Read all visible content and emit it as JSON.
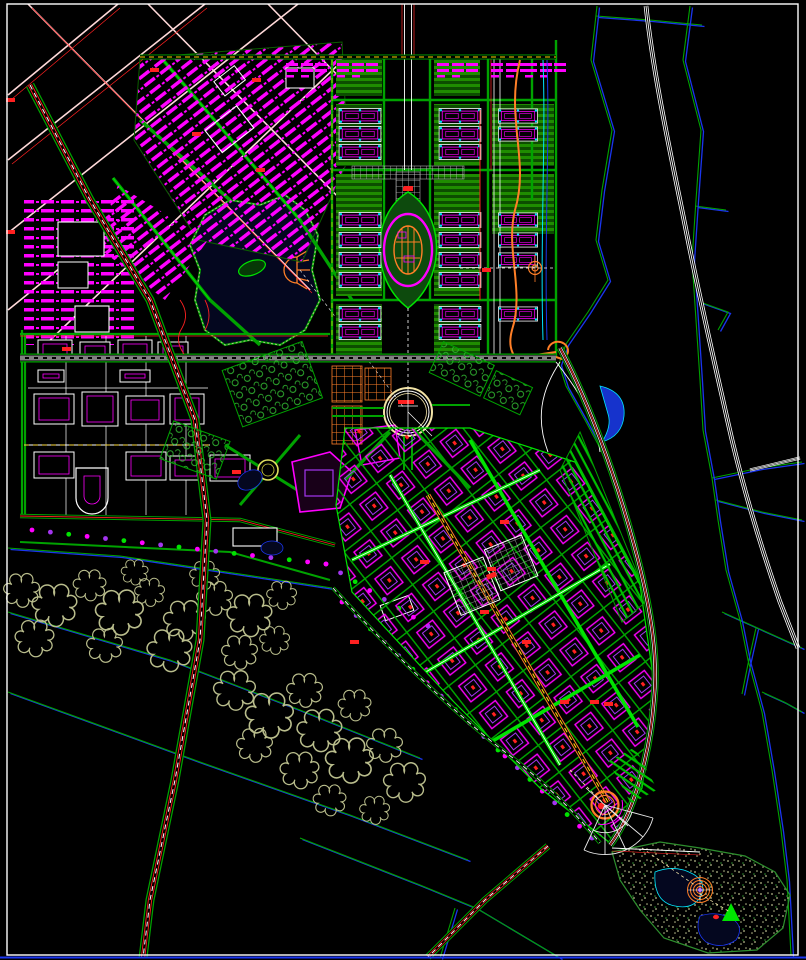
{
  "palette": {
    "background": "#000000",
    "frame_white": "#ffffff",
    "green_bright": "#00e400",
    "green_mid": "#00a300",
    "green_dark": "#0b5e00",
    "magenta": "#ff00ff",
    "violet": "#a435f0",
    "red": "#ff2121",
    "orange": "#ff7f27",
    "yellow": "#ffd400",
    "white": "#ffffff",
    "pink": "#ffd9d9",
    "cyan": "#00e5ff",
    "blue": "#1a35ee",
    "navy": "#04071f",
    "khaki": "#b9bd8c",
    "gray": "#b0b0b0",
    "pale": "#f2e3a6"
  },
  "map": {
    "channels": [
      {
        "pts": [
          [
            8,
            548
          ],
          [
            120,
            556
          ],
          [
            240,
            574
          ],
          [
            332,
            588
          ]
        ]
      },
      {
        "pts": [
          [
            8,
            612
          ],
          [
            170,
            660
          ],
          [
            300,
            710
          ],
          [
            420,
            758
          ]
        ]
      },
      {
        "pts": [
          [
            8,
            692
          ],
          [
            200,
            762
          ],
          [
            350,
            815
          ],
          [
            468,
            860
          ]
        ]
      },
      {
        "pts": [
          [
            300,
            838
          ],
          [
            420,
            885
          ],
          [
            476,
            908
          ],
          [
            560,
            958
          ]
        ]
      },
      {
        "pts": [
          [
            455,
            908
          ],
          [
            440,
            958
          ]
        ]
      },
      {
        "pts": [
          [
            596,
            16
          ],
          [
            650,
            20
          ],
          [
            702,
            25
          ]
        ]
      },
      {
        "pts": [
          [
            695,
            206
          ],
          [
            726,
            210
          ]
        ]
      },
      {
        "pts": [
          [
            700,
            302
          ],
          [
            728,
            312
          ],
          [
            718,
            330
          ]
        ]
      },
      {
        "pts": [
          [
            712,
            478
          ],
          [
            760,
            468
          ],
          [
            802,
            462
          ]
        ]
      },
      {
        "pts": [
          [
            716,
            500
          ],
          [
            762,
            512
          ],
          [
            802,
            520
          ]
        ]
      },
      {
        "pts": [
          [
            722,
            612
          ],
          [
            762,
            630
          ],
          [
            802,
            648
          ]
        ]
      },
      {
        "pts": [
          [
            756,
            628
          ],
          [
            748,
            664
          ],
          [
            742,
            694
          ]
        ]
      },
      {
        "pts": [
          [
            762,
            692
          ],
          [
            784,
            702
          ],
          [
            802,
            712
          ]
        ]
      },
      {
        "pts": [
          [
            597,
            6
          ],
          [
            591,
            60
          ],
          [
            612,
            130
          ],
          [
            602,
            190
          ],
          [
            596,
            240
          ],
          [
            608,
            280
          ],
          [
            588,
            312
          ],
          [
            566,
            344
          ],
          [
            559,
            364
          ],
          [
            566,
            386
          ],
          [
            585,
            420
          ],
          [
            600,
            448
          ],
          [
            610,
            470
          ]
        ]
      },
      {
        "pts": [
          [
            690,
            6
          ],
          [
            683,
            60
          ],
          [
            701,
            130
          ],
          [
            696,
            200
          ],
          [
            692,
            260
          ],
          [
            696,
            320
          ],
          [
            700,
            380
          ],
          [
            703,
            430
          ],
          [
            712,
            478
          ],
          [
            718,
            520
          ],
          [
            726,
            570
          ],
          [
            740,
            620
          ],
          [
            748,
            660
          ],
          [
            762,
            712
          ],
          [
            772,
            770
          ],
          [
            781,
            830
          ],
          [
            787,
            880
          ],
          [
            791,
            955
          ]
        ]
      }
    ],
    "forest_clusters": [
      [
        22,
        590,
        1.2
      ],
      [
        55,
        605,
        1.5
      ],
      [
        90,
        585,
        1.1
      ],
      [
        120,
        612,
        1.6
      ],
      [
        150,
        592,
        1.0
      ],
      [
        185,
        620,
        1.4
      ],
      [
        215,
        598,
        1.2
      ],
      [
        250,
        615,
        1.5
      ],
      [
        282,
        595,
        1.0
      ],
      [
        35,
        638,
        1.3
      ],
      [
        105,
        645,
        1.2
      ],
      [
        170,
        650,
        1.5
      ],
      [
        240,
        652,
        1.2
      ],
      [
        275,
        640,
        1.0
      ],
      [
        135,
        572,
        0.9
      ],
      [
        205,
        575,
        1.0
      ],
      [
        235,
        690,
        1.4
      ],
      [
        270,
        715,
        1.6
      ],
      [
        305,
        690,
        1.2
      ],
      [
        320,
        730,
        1.5
      ],
      [
        355,
        705,
        1.1
      ],
      [
        350,
        760,
        1.6
      ],
      [
        300,
        770,
        1.3
      ],
      [
        385,
        745,
        1.2
      ],
      [
        405,
        782,
        1.4
      ],
      [
        330,
        800,
        1.1
      ],
      [
        375,
        810,
        1.0
      ],
      [
        255,
        745,
        1.2
      ]
    ],
    "axis_units": [
      [
        337,
        108,
        46
      ],
      [
        337,
        126,
        46
      ],
      [
        337,
        144,
        46
      ],
      [
        437,
        108,
        46
      ],
      [
        437,
        126,
        46
      ],
      [
        437,
        144,
        46
      ],
      [
        337,
        212,
        46
      ],
      [
        337,
        232,
        46
      ],
      [
        337,
        252,
        46
      ],
      [
        337,
        272,
        46
      ],
      [
        437,
        212,
        46
      ],
      [
        437,
        232,
        46
      ],
      [
        437,
        252,
        46
      ],
      [
        437,
        272,
        46
      ],
      [
        337,
        306,
        46
      ],
      [
        337,
        324,
        46
      ],
      [
        437,
        306,
        46
      ],
      [
        437,
        324,
        46
      ],
      [
        498,
        108,
        40
      ],
      [
        498,
        126,
        40
      ],
      [
        498,
        212,
        40
      ],
      [
        498,
        232,
        40
      ],
      [
        498,
        252,
        40
      ],
      [
        498,
        306,
        40
      ]
    ],
    "shop_rows": [
      [
        285,
        62
      ],
      [
        336,
        62
      ],
      [
        436,
        62
      ],
      [
        490,
        62
      ],
      [
        524,
        62
      ]
    ],
    "left_buildings": [
      [
        38,
        340,
        34,
        22
      ],
      [
        80,
        342,
        30,
        20
      ],
      [
        118,
        340,
        34,
        22
      ],
      [
        158,
        342,
        30,
        20
      ],
      [
        38,
        370,
        26,
        12
      ],
      [
        120,
        370,
        30,
        12
      ],
      [
        34,
        394,
        40,
        30
      ],
      [
        82,
        392,
        36,
        34
      ],
      [
        126,
        396,
        38,
        28
      ],
      [
        170,
        394,
        34,
        30
      ],
      [
        34,
        452,
        40,
        26
      ],
      [
        126,
        452,
        40,
        28
      ],
      [
        170,
        456,
        32,
        24
      ],
      [
        210,
        455,
        40,
        26
      ]
    ],
    "tree_rows": [
      {
        "a": [
          32,
          530
        ],
        "b": [
          326,
          564
        ],
        "n": 16
      },
      {
        "a": [
          326,
          564
        ],
        "b": [
          428,
          626
        ],
        "n": 7
      },
      {
        "a": [
          342,
          602
        ],
        "b": [
          498,
          750
        ],
        "n": 11
      },
      {
        "a": [
          505,
          756
        ],
        "b": [
          592,
          838
        ],
        "n": 7
      }
    ],
    "red_marks": [
      [
        150,
        68
      ],
      [
        252,
        78
      ],
      [
        192,
        132
      ],
      [
        256,
        168
      ],
      [
        62,
        347
      ],
      [
        232,
        470
      ],
      [
        482,
        268
      ],
      [
        404,
        186
      ],
      [
        487,
        567
      ],
      [
        522,
        640
      ],
      [
        560,
        700
      ],
      [
        480,
        610
      ],
      [
        604,
        702
      ],
      [
        6,
        98
      ],
      [
        6,
        230
      ],
      [
        350,
        640
      ],
      [
        420,
        560
      ],
      [
        500,
        520
      ],
      [
        590,
        700
      ]
    ]
  }
}
